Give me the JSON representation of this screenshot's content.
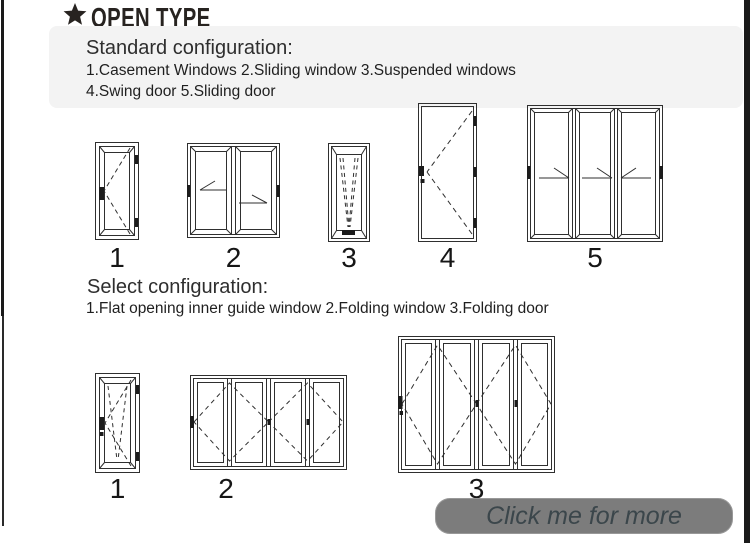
{
  "header": {
    "title": "OPEN TYPE"
  },
  "standard": {
    "heading": "Standard configuration:",
    "items_line1": "1.Casement Windows  2.Sliding window  3.Suspended windows",
    "items_line2": "4.Swing door  5.Sliding door",
    "figures": [
      {
        "label": "1",
        "name": "Casement Windows"
      },
      {
        "label": "2",
        "name": "Sliding window"
      },
      {
        "label": "3",
        "name": "Suspended windows"
      },
      {
        "label": "4",
        "name": "Swing door"
      },
      {
        "label": "5",
        "name": "Sliding door"
      }
    ]
  },
  "select": {
    "heading": "Select configuration:",
    "items_line1": "1.Flat opening inner guide window  2.Folding window  3.Folding door",
    "figures": [
      {
        "label": "1",
        "name": "Flat opening inner guide window"
      },
      {
        "label": "2",
        "name": "Folding window"
      },
      {
        "label": "3",
        "name": "Folding door"
      }
    ]
  },
  "cta": {
    "label": "Click me for more"
  },
  "colors": {
    "edge_bar": "#1a1a1a",
    "panel_bg": "#f3f3f3",
    "cta_bg": "#7c7c7c",
    "cta_text": "#3b464b",
    "line_art": "#2f2f2f"
  }
}
